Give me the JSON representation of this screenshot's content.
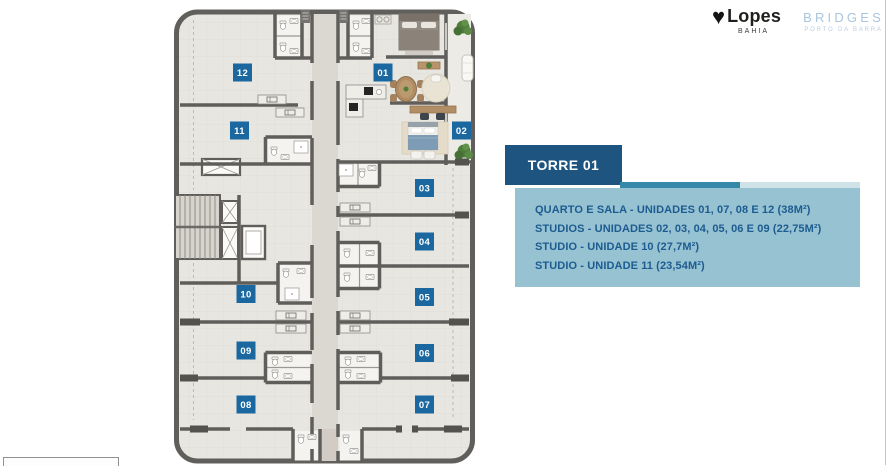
{
  "brand": {
    "lopes": {
      "name": "Lopes",
      "region": "BAHIA"
    },
    "bridges": {
      "name": "BRIDGES",
      "subtitle": "PORTO DA BARRA"
    }
  },
  "icons": {
    "heart_glyph": "♥"
  },
  "panel": {
    "title": "TORRE 01",
    "legend": [
      "QUARTO E SALA - UNIDADES 01, 07, 08 E 12 (38M²)",
      "STUDIOS - UNIDADES 02, 03, 04, 05, 06 E 09 (22,75M²)",
      "STUDIO - UNIDADE 10 (27,7M²)",
      "STUDIO - UNIDADE 11 (23,54M²)"
    ],
    "colors": {
      "header_bg": "#1d5480",
      "bar_dark": "#3688a8",
      "bar_light": "#cfe2e8",
      "legend_bg": "#97c2d2",
      "legend_text": "#1d5c90"
    }
  },
  "floorplan": {
    "badge_color": "#1a689f",
    "units": [
      {
        "label": "12"
      },
      {
        "label": "01"
      },
      {
        "label": "11"
      },
      {
        "label": "02"
      },
      {
        "label": "03"
      },
      {
        "label": "04"
      },
      {
        "label": "10"
      },
      {
        "label": "05"
      },
      {
        "label": "09"
      },
      {
        "label": "06"
      },
      {
        "label": "08"
      },
      {
        "label": "07"
      }
    ]
  }
}
